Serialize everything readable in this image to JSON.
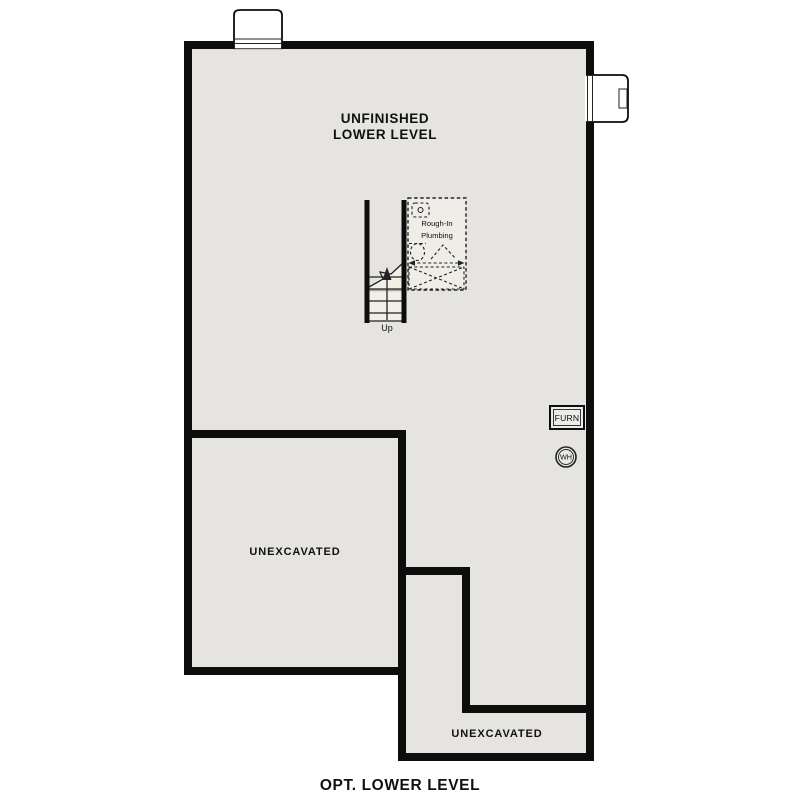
{
  "page": {
    "title": "OPT. LOWER LEVEL"
  },
  "colors": {
    "background": "#ffffff",
    "floor": "#e5e4e1",
    "wall": "#0d0d0d",
    "stair_fill": "#f2efe7",
    "plumbing_fill": "#efede7",
    "line": "#222222",
    "text": "#111111"
  },
  "labels": {
    "main_room_line1": "UNFINISHED",
    "main_room_line2": "LOWER LEVEL",
    "unexcavated_left": "UNEXCAVATED",
    "unexcavated_bottom": "UNEXCAVATED",
    "stairs_up": "Up",
    "plumbing_line1": "Rough-In",
    "plumbing_line2": "Plumbing",
    "furnace": "FURN",
    "water_heater": "WH"
  }
}
